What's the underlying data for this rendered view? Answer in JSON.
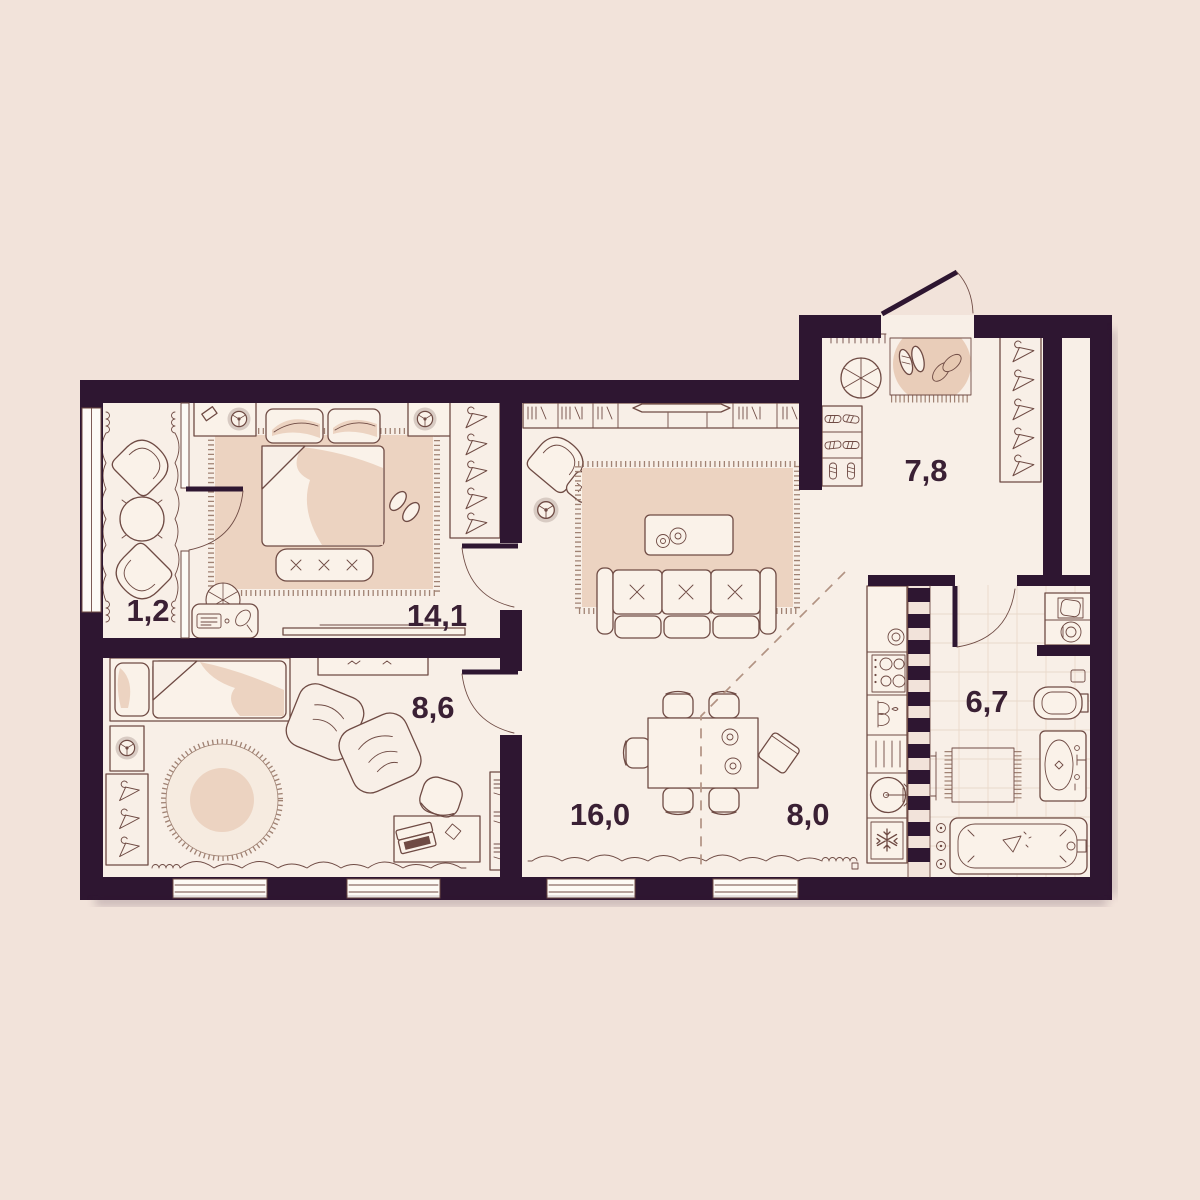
{
  "page": {
    "background": "#f2e3da"
  },
  "plan": {
    "colors": {
      "wall": "#2e1631",
      "floor": "#f8efe7",
      "furniture_fill": "#faf2e9",
      "accent_pink": "#ecd3c1",
      "outline": "#6f4b44",
      "label": "#3a2034"
    },
    "rooms": {
      "balcony": {
        "area": "1,2"
      },
      "bedroom": {
        "area": "14,1"
      },
      "kids_room": {
        "area": "8,6"
      },
      "living_room": {
        "area": "16,0"
      },
      "kitchen": {
        "area": "8,0"
      },
      "hallway": {
        "area": "7,8"
      },
      "bathroom": {
        "area": "6,7"
      }
    },
    "icons": [
      "hanger-icon",
      "lamp-icon",
      "pouf-icon",
      "snowflake-icon",
      "sparkle-icon",
      "shoe-icon",
      "stove-burner-icon",
      "sink-icon",
      "washer-icon",
      "books-icon"
    ]
  }
}
